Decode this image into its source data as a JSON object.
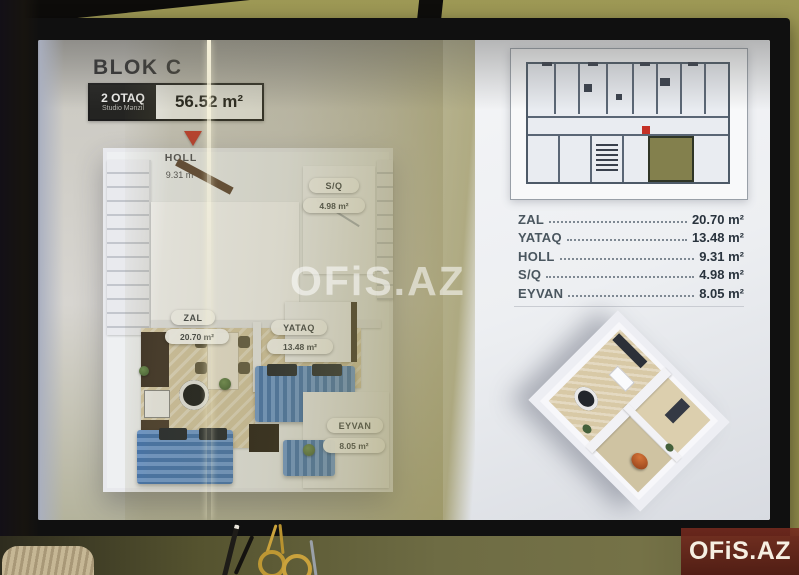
{
  "slide": {
    "block_title": "BLOK C",
    "badge": {
      "rooms": "2 OTAQ",
      "type": "Studio Mənzil",
      "area": "56.52 m²"
    },
    "floorplan": {
      "rooms": [
        {
          "name": "HOLL",
          "area": "9.31 m²"
        },
        {
          "name": "S/Q",
          "area": "4.98 m²"
        },
        {
          "name": "ZAL",
          "area": "20.70 m²"
        },
        {
          "name": "YATAQ",
          "area": "13.48 m²"
        },
        {
          "name": "EYVAN",
          "area": "8.05 m²"
        }
      ]
    },
    "area_table": {
      "rows": [
        {
          "label": "ZAL",
          "value": "20.70 m²"
        },
        {
          "label": "YATAQ",
          "value": "13.48 m²"
        },
        {
          "label": "HOLL",
          "value": "9.31 m²"
        },
        {
          "label": "S/Q",
          "value": "4.98 m²"
        },
        {
          "label": "EYVAN",
          "value": "8.05 m²"
        }
      ]
    },
    "watermark": "OFiS.AZ"
  },
  "brand_label": "OFiS.AZ",
  "colors": {
    "accent_red": "#c5372a",
    "highlight_olive": "#83804d",
    "sofa_blue": "#3f73b6",
    "wall_olive": "#97924f",
    "brand_bg": "#6b2518",
    "brand_text": "#f6efe2"
  }
}
